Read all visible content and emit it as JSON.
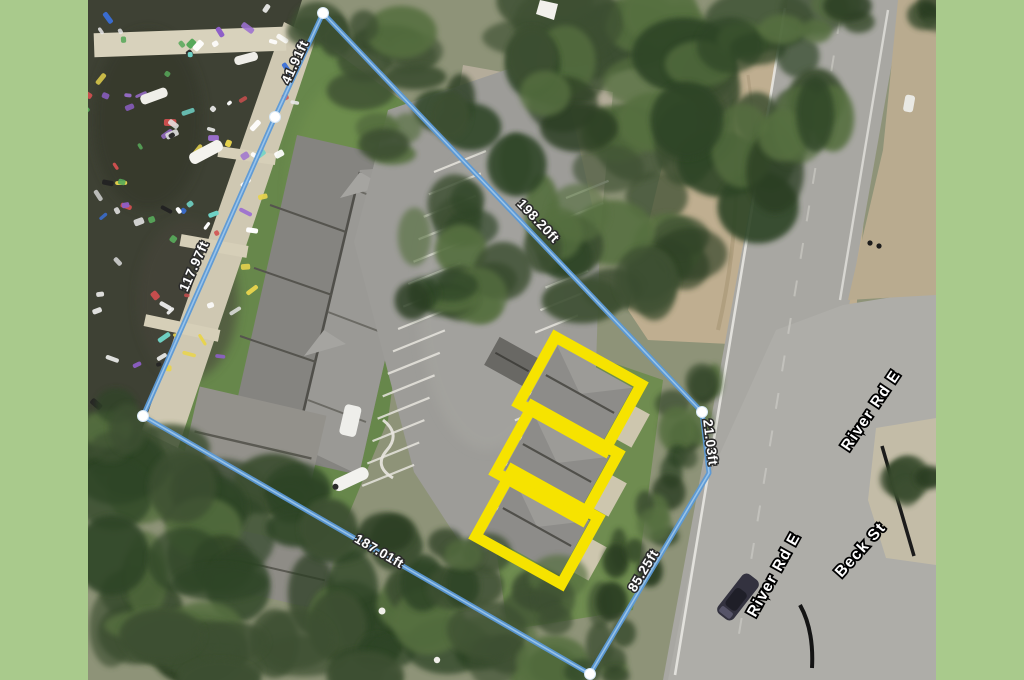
{
  "frame": {
    "color": "#a9ca8c"
  },
  "map": {
    "type": "satellite-parcel-measurement",
    "parcel": {
      "line_color": "#5b99d6",
      "vertex_color": "#ffffff",
      "measurements": [
        {
          "id": "seg-top-left",
          "label": "41.91ft"
        },
        {
          "id": "seg-top-right",
          "label": "198.20ft"
        },
        {
          "id": "seg-left",
          "label": "117.97ft"
        },
        {
          "id": "seg-right-upper",
          "label": "21.03ft"
        },
        {
          "id": "seg-right-lower",
          "label": "85.25ft"
        },
        {
          "id": "seg-bottom",
          "label": "187.01ft"
        }
      ]
    },
    "highlights": {
      "color": "#f6e300",
      "count": 3
    },
    "roads": [
      {
        "id": "river-rd-upper",
        "label": "River Rd E"
      },
      {
        "id": "river-rd-lower",
        "label": "River Rd E"
      },
      {
        "id": "beck-st",
        "label": "Beck St"
      }
    ]
  }
}
